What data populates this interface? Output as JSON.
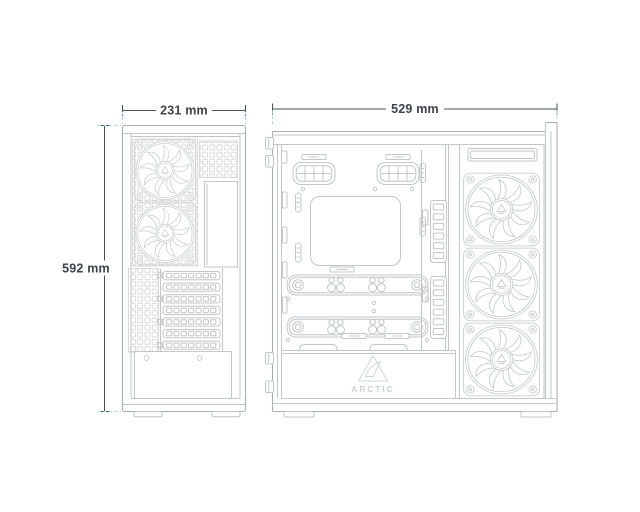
{
  "views": {
    "rear": {
      "width_label": "231 mm",
      "height_label": "592 mm",
      "fan_count": 2,
      "pci_slot_count": 7
    },
    "side": {
      "width_label": "529 mm",
      "fan_count": 3
    }
  },
  "brand": {
    "logo_text": "ARCTIC"
  },
  "colors": {
    "background": "#ffffff",
    "line": "#c2c6c9",
    "outline": "#a9aeb2",
    "dimension_text": "#3d4348",
    "extension_line": "#a5d8e4",
    "logo": "#cdd0d3"
  }
}
